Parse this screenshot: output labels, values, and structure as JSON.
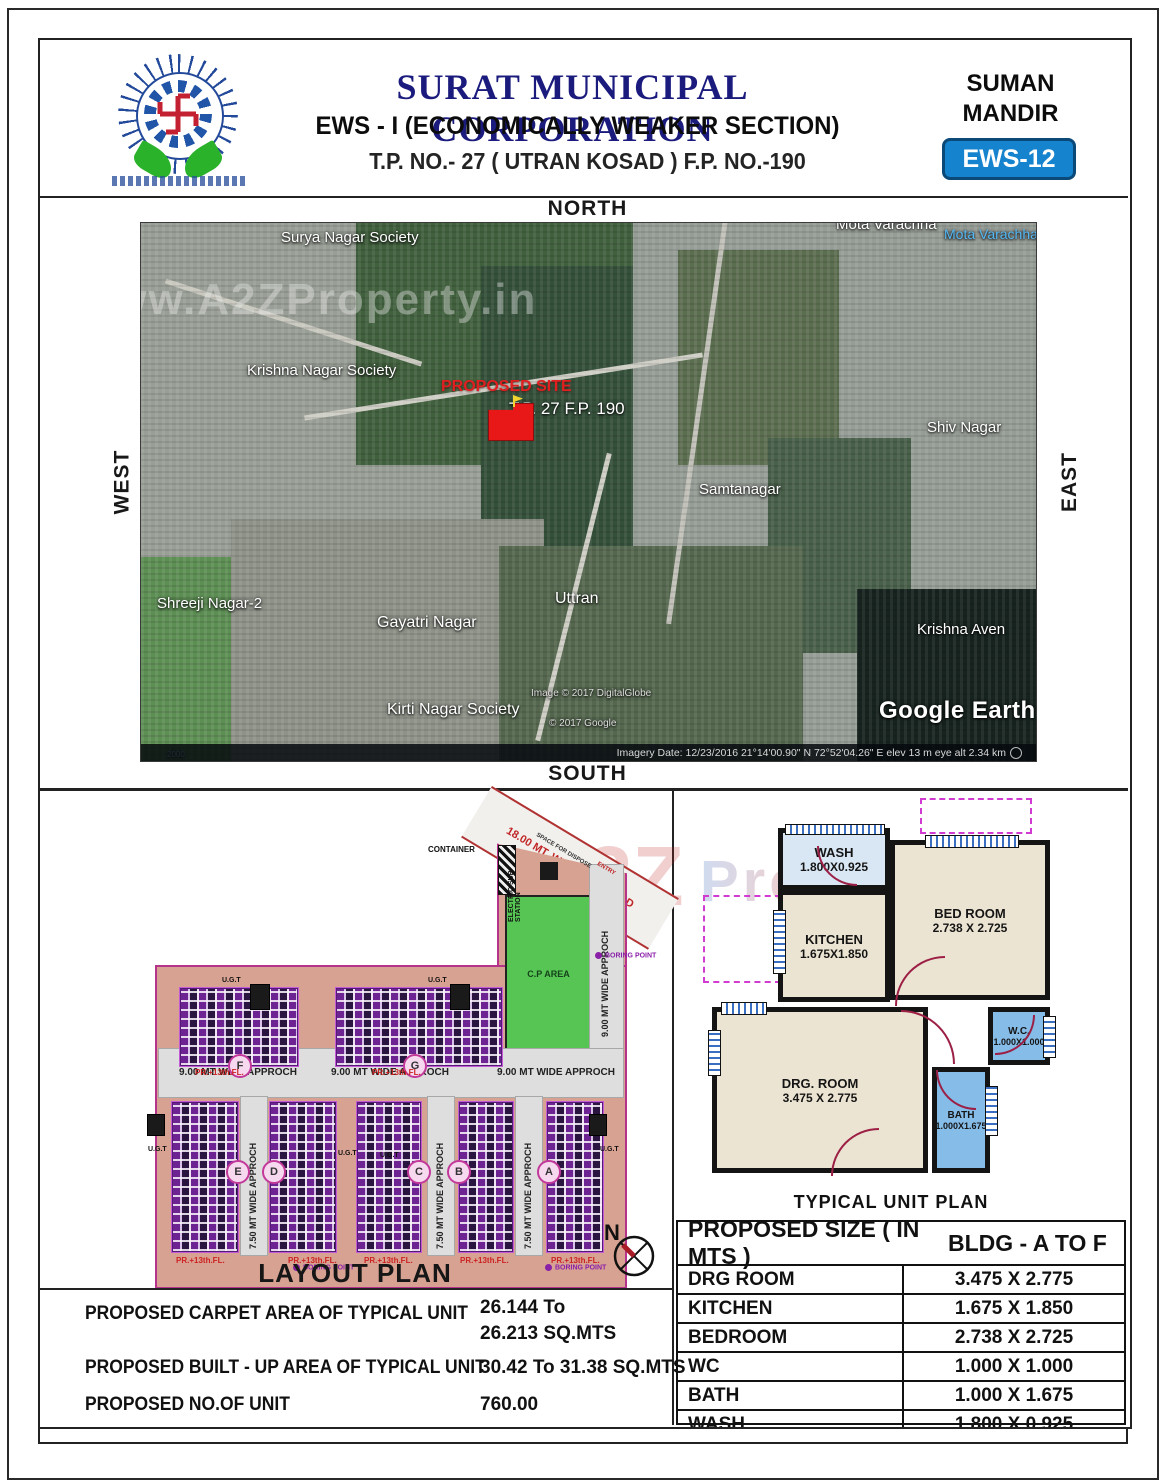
{
  "header": {
    "org": "SURAT MUNICIPAL CORPORATION",
    "scheme": "EWS - I (ECONOMICALLY WEAKER SECTION)",
    "tp_line": "T.P. NO.- 27 ( UTRAN KOSAD ) F.P. NO.-190",
    "project_line1": "SUMAN",
    "project_line2": "MANDIR",
    "badge": "EWS-12"
  },
  "directions": {
    "north": "NORTH",
    "south": "SOUTH",
    "east": "EAST",
    "west": "WEST"
  },
  "map": {
    "watermark": "www.A2ZProperty.in",
    "labels": {
      "mota_top": "Mota Varachha",
      "mota_blue": "Mota Varachha",
      "surya": "Surya Nagar Society",
      "krishna_nagar": "Krishna Nagar Society",
      "shiv": "Shiv Nagar",
      "samtanagar": "Samtanagar",
      "shreeji": "Shreeji Nagar-2",
      "gayatri": "Gayatri Nagar",
      "uttran": "Uttran",
      "krishna_aven": "Krishna Aven",
      "kirti": "Kirti Nagar Society"
    },
    "proposed_site": "PROPOSED SITE",
    "site_ref": "T.P. 27  F.P. 190",
    "credit1": "Image © 2017 DigitalGlobe",
    "credit2": "© 2017 Google",
    "earth_logo": "Google Earth",
    "scale": "2000",
    "status": "Imagery Date: 12/23/2016     21°14'00.90\" N   72°52'04.26\" E   elev    13 m    eye alt    2.34 km"
  },
  "layout": {
    "title": "LAYOUT PLAN",
    "tps_road": "18.00 MT. WIDE T.P.S. ROAD",
    "container": "CONTAINER",
    "electric": "ELECTRIC SUB STATION",
    "space": "SPACE FOR DISPOSE",
    "entry": "ENTRY",
    "cp_area": "C.P AREA",
    "approach_9": "9.00 MT WIDE APPROCH",
    "approach_75": "7.50 MT WIDE APPROCH",
    "ugt": "U.G.T",
    "boring": "BORING POINT",
    "pr_floor": "PR.+13th.FL.",
    "buildings": [
      "F",
      "G",
      "E",
      "D",
      "C",
      "B",
      "A"
    ],
    "north_letter": "N",
    "watermark": "A2Z"
  },
  "unit_plan": {
    "title": "TYPICAL UNIT PLAN",
    "watermark": "Property",
    "rooms": [
      {
        "name": "WASH",
        "dim": "1.800X0.925"
      },
      {
        "name": "KITCHEN",
        "dim": "1.675X1.850"
      },
      {
        "name": "BED ROOM",
        "dim": "2.738 X 2.725"
      },
      {
        "name": "W.C.",
        "dim": "1.000X1.000"
      },
      {
        "name": "DRG. ROOM",
        "dim": "3.475 X 2.775"
      },
      {
        "name": "BATH",
        "dim": "1.000X1.675"
      }
    ]
  },
  "size_table": {
    "col1": "PROPOSED SIZE ( IN MTS )",
    "col2": "BLDG - A TO F",
    "rows": [
      {
        "room": "DRG ROOM",
        "size": "3.475 X 2.775"
      },
      {
        "room": "KITCHEN",
        "size": "1.675 X 1.850"
      },
      {
        "room": "BEDROOM",
        "size": "2.738 X 2.725"
      },
      {
        "room": "WC",
        "size": "1.000 X 1.000"
      },
      {
        "room": "BATH",
        "size": "1.000 X 1.675"
      },
      {
        "room": "WASH",
        "size": "1.800 X 0.925"
      }
    ]
  },
  "summary": {
    "rows": [
      {
        "label": "PROPOSED CARPET AREA OF TYPICAL UNIT",
        "value1": "26.144 To",
        "value2": "26.213 SQ.MTS"
      },
      {
        "label": "PROPOSED BUILT - UP  AREA OF TYPICAL UNIT",
        "value": "30.42 To 31.38 SQ.MTS"
      },
      {
        "label": "PROPOSED NO.OF UNIT",
        "value": "760.00"
      }
    ]
  },
  "colors": {
    "title_navy": "#1b1b7e",
    "badge_blue": "#1583cd",
    "site_salmon": "#d8a292",
    "cp_green": "#57c553",
    "site_red": "#e81818",
    "room_blue": "#85bce8"
  }
}
